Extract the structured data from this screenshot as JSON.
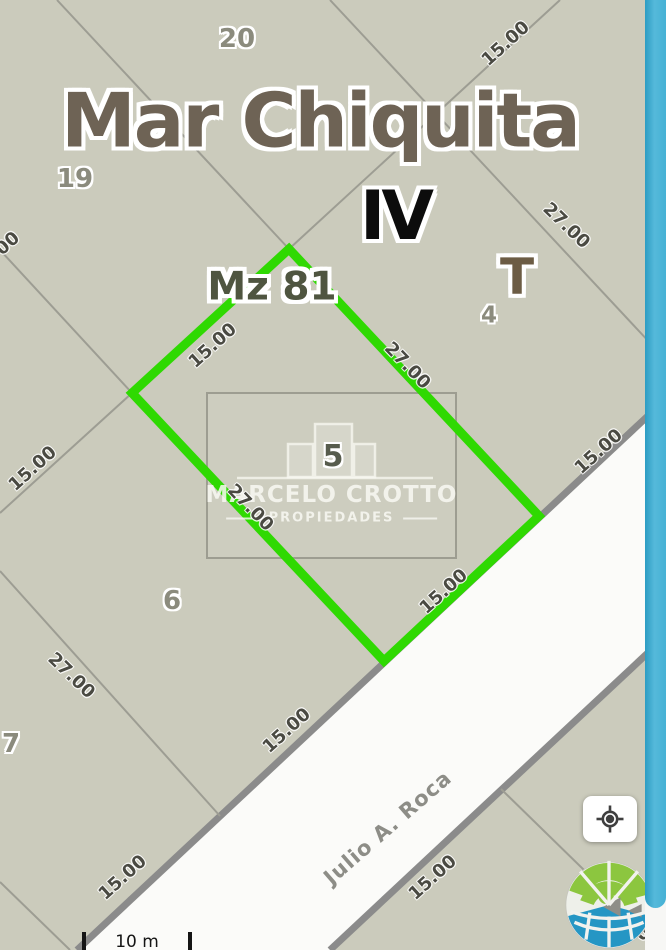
{
  "map": {
    "region_title": "Mar Chiquita",
    "section_roman": "IV",
    "block_label": "Mz 81",
    "zone_label": "T",
    "street_name": "Julio A. Roca",
    "highlighted_lot_number": "5",
    "labels": [
      {
        "name": "lot-20-label",
        "text": "20",
        "x": 237,
        "y": 39,
        "rot": 0,
        "type": "lot"
      },
      {
        "name": "dim-label-top",
        "text": "15.00",
        "x": 506,
        "y": 44,
        "rot": -42,
        "type": "dim"
      },
      {
        "name": "region-title",
        "text": "Mar Chiquita",
        "x": 320,
        "y": 121,
        "rot": 0,
        "type": "title"
      },
      {
        "name": "lot-19-label",
        "text": "19",
        "x": 75,
        "y": 179,
        "rot": 0,
        "type": "lot"
      },
      {
        "name": "section-roman-label",
        "text": "IV",
        "x": 395,
        "y": 217,
        "rot": 0,
        "type": "roman"
      },
      {
        "name": "dim-label-upper-right",
        "text": "27.00",
        "x": 566,
        "y": 226,
        "rot": 44,
        "type": "dim"
      },
      {
        "name": "dim-label-left-clipped",
        "text": "00",
        "x": 8,
        "y": 244,
        "rot": -42,
        "type": "dim"
      },
      {
        "name": "zone-label",
        "text": "T",
        "x": 517,
        "y": 277,
        "rot": 0,
        "type": "zone"
      },
      {
        "name": "block-label",
        "text": "Mz 81",
        "x": 272,
        "y": 287,
        "rot": 0,
        "type": "block"
      },
      {
        "name": "lot-4-label",
        "text": "4",
        "x": 489,
        "y": 316,
        "rot": 0,
        "type": "lot-sm"
      },
      {
        "name": "dim-label-parcel-nw",
        "text": "15.00",
        "x": 213,
        "y": 346,
        "rot": -42,
        "type": "dim"
      },
      {
        "name": "dim-label-parcel-ne",
        "text": "27.00",
        "x": 407,
        "y": 366,
        "rot": 46,
        "type": "dim"
      },
      {
        "name": "dim-label-top-right-frontage",
        "text": "15.00",
        "x": 599,
        "y": 452,
        "rot": -42,
        "type": "dim"
      },
      {
        "name": "lot-5-label",
        "text": "5",
        "x": 333,
        "y": 457,
        "rot": 0,
        "type": "lot-5"
      },
      {
        "name": "dim-label-left-edge",
        "text": "15.00",
        "x": 33,
        "y": 469,
        "rot": -42,
        "type": "dim"
      },
      {
        "name": "dim-label-parcel-sw",
        "text": "27.00",
        "x": 250,
        "y": 508,
        "rot": 46,
        "type": "dim"
      },
      {
        "name": "dim-label-parcel-se",
        "text": "15.00",
        "x": 444,
        "y": 592,
        "rot": -42,
        "type": "dim"
      },
      {
        "name": "lot-6-label",
        "text": "6",
        "x": 172,
        "y": 601,
        "rot": 0,
        "type": "lot"
      },
      {
        "name": "dim-label-lower-left",
        "text": "27.00",
        "x": 71,
        "y": 676,
        "rot": 44,
        "type": "dim"
      },
      {
        "name": "dim-label-frontage-left",
        "text": "15.00",
        "x": 287,
        "y": 731,
        "rot": -42,
        "type": "dim"
      },
      {
        "name": "lot-7-label",
        "text": "7",
        "x": 11,
        "y": 744,
        "rot": 0,
        "type": "lot"
      },
      {
        "name": "street-name-label",
        "text": "Julio A. Roca",
        "x": 388,
        "y": 828,
        "rot": -41,
        "type": "street"
      },
      {
        "name": "dim-label-frontage-bottom",
        "text": "15.00",
        "x": 123,
        "y": 878,
        "rot": -42,
        "type": "dim"
      },
      {
        "name": "dim-label-south-block",
        "text": "15.00",
        "x": 433,
        "y": 878,
        "rot": -42,
        "type": "dim"
      },
      {
        "name": "dim-label-south-clipped",
        "text": "00",
        "x": 648,
        "y": 930,
        "rot": -42,
        "type": "dim"
      }
    ]
  },
  "watermark": {
    "agency_name": "MARCELO CROTTO",
    "tagline": "PROPIEDADES",
    "icon": "buildings-icon"
  },
  "scalebar": {
    "label": "10 m"
  },
  "controls": {
    "locate_button_icon": "gps-target-icon"
  },
  "logo": {
    "icon": "globe-logo-icon"
  },
  "colors": {
    "map_background": "#cbcbbc",
    "street_fill": "#fbfbf9",
    "street_border": "#8b8b8b",
    "parcel_line": "#9d9d93",
    "parcel_highlight": "#2fd902",
    "scrollbar_thumb": "#49b2d6",
    "scrollbar_track": "#f7f7f5"
  }
}
